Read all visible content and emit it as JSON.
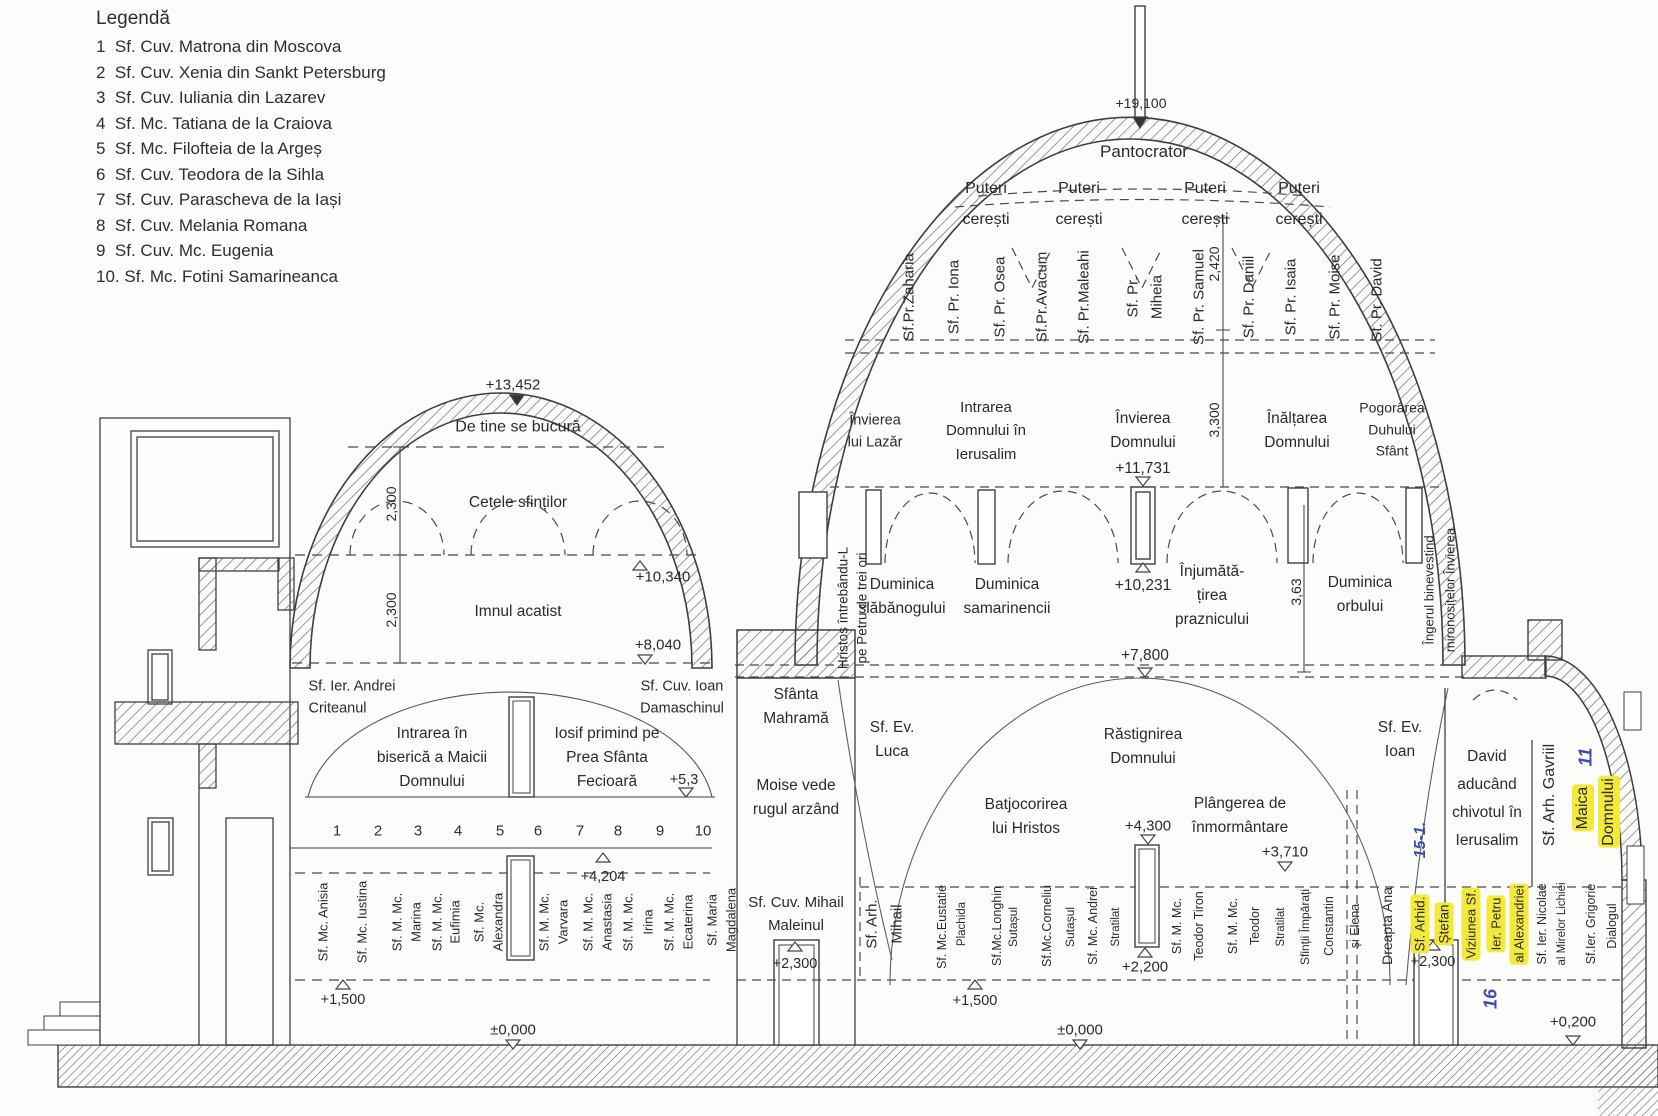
{
  "legend": {
    "title": "Legendă",
    "items": [
      {
        "no": "1",
        "name": "Sf. Cuv. Matrona din Moscova"
      },
      {
        "no": "2",
        "name": "Sf. Cuv. Xenia din Sankt Petersburg"
      },
      {
        "no": "3",
        "name": "Sf. Cuv. Iuliania din Lazarev"
      },
      {
        "no": "4",
        "name": "Sf. Mc. Tatiana de la Craiova"
      },
      {
        "no": "5",
        "name": "Sf. Mc. Filofteia de la Argeș"
      },
      {
        "no": "6",
        "name": "Sf. Cuv. Teodora de la Sihla"
      },
      {
        "no": "7",
        "name": "Sf. Cuv. Parascheva de la Iași"
      },
      {
        "no": "8",
        "name": "Sf. Cuv. Melania Romana"
      },
      {
        "no": "9",
        "name": "Sf. Cuv. Mc. Eugenia"
      },
      {
        "no": "10.",
        "name": "Sf. Mc. Fotini Samarineanca"
      }
    ]
  },
  "main_dome": {
    "apex_elev": "+19,100",
    "pantocrator": "Pantocrator",
    "puteri": "Puteri\ncerești",
    "prophets": [
      "Sf.Pr.Zaharia",
      "Sf. Pr. Iona",
      "Sf. Pr. Osea",
      "Sf.Pr.Avacum",
      "Sf. Pr.Maleahi",
      "Sf. Pr.",
      "Miheia",
      "Sf. Pr. Samuel",
      "Sf. Pr. Daniil",
      "Sf. Pr. Isaia",
      "Sf. Pr. Moise",
      "Sf. Pr. David"
    ],
    "dim_2420": "2,420",
    "dim_3300": "3,300",
    "invierea_lazar": "Învierea\nlui Lazăr",
    "intrarea_ierusalim": "Intrarea\nDomnului în\nIerusalim",
    "invierea_domnului": "Învierea\nDomnului",
    "inaltarea": "Înălțarea\nDomnului",
    "pogorarea": "Pogorârea\nDuhului\nSfânt",
    "elev_11731": "+11,731",
    "hristos_l1": "Hristos întrebându-L",
    "hristos_l2": "pe Petru de trei ori",
    "slabanogului": "Duminica\nslăbănogului",
    "samarinencii": "Duminica\nsamarinencii",
    "elev_10231": "+10,231",
    "injumatatirea": "Înjumătă-\nțirea\npraznicului",
    "dim_363": "3,63",
    "orbului": "Duminica\norbului",
    "ingerul_l1": "Îngerul binevestind",
    "ingerul_l2": "mironosițelor Învierea",
    "elev_7800": "+7,800"
  },
  "nave": {
    "sfanta_mahrama": "Sfânta\nMahramă",
    "sf_ev_luca": "Sf. Ev.\nLuca",
    "moise_rugul": "Moise vede\nrugul arzând",
    "rastignirea": "Răstignirea\nDomnului",
    "batjocorirea": "Batjocorirea\nlui Hristos",
    "elev_4300": "+4,300",
    "elev_2200": "+2,200",
    "plangerea": "Plângerea de\nînmormântare",
    "elev_3710": "+3,710",
    "sf_ev_ioan": "Sf. Ev.\nIoan",
    "arh_mihail_l1": "Sf. Arh.",
    "arh_mihail_l2": "Mihail",
    "saints": [
      "Sf. Mc.Eustatie",
      "Plachida",
      "Sf.Mc.Longhin",
      "Sutașul",
      "Sf.Mc.Corneliu",
      "Sutașul",
      "Sf. Mc. Andrei",
      "Stratilat",
      "Sf. M. Mc.",
      "Teodor Tiron",
      "Sf. M. Mc.",
      "Teodor",
      "Stratilat",
      "Sfinții Împărați",
      "Constantin",
      "și Elena"
    ],
    "dreapta_ana": "Dreapta Ana",
    "elev_1500": "+1,500",
    "elev_0000": "±0,000"
  },
  "left_dome": {
    "elev_13452": "+13,452",
    "de_tine": "De tine se bucură",
    "cetele": "Cetele sfinților",
    "dim_2300": "2,300",
    "elev_10340": "+10,340",
    "imnul": "Imnul acatist",
    "elev_8040": "+8,040",
    "andrei_criteanul": "Sf. Ier. Andrei\nCriteanul",
    "ioan_damaschinul": "Sf. Cuv. Ioan\nDamaschinul",
    "intrarea_biserica": "Intrarea în\nbiserică a Maicii\nDomnului",
    "iosif_primind": "Iosif primind pe\nPrea Sfânta\nFecioară",
    "elev_53": "+5,3",
    "numbers": [
      "1",
      "2",
      "3",
      "4",
      "5",
      "6",
      "7",
      "8",
      "9",
      "10"
    ],
    "elev_4204": "+4,204",
    "saints": [
      "Sf. Mc. Anisia",
      "Sf. Mc. Iustina",
      "Sf. M. Mc.",
      "Marina",
      "Sf. M. Mc.",
      "Eufimia",
      "Sf. Mc.",
      "Alexandra",
      "Sf. M. Mc.",
      "Varvara",
      "Sf. M. Mc.",
      "Anastasia",
      "Sf. M. Mc.",
      "Irina",
      "Sf. M. Mc.",
      "Ecaterina",
      "Sf. Maria",
      "Magdalena"
    ],
    "elev_1500": "+1,500",
    "elev_0000": "±0,000"
  },
  "narthex": {
    "mihail_maleinul": "Sf. Cuv. Mihail\nMaleinul",
    "elev_2300": "+2,300"
  },
  "chapel": {
    "david": "David\naducând\nchivotul în\nIerusalim",
    "gavriil": "Sf. Arh. Gavriil",
    "maica_l1": "Maica",
    "maica_l2": "Domnului",
    "stefan_l1": "Sf. Arhid.",
    "stefan_l2": "Ștefan",
    "elev_2300": "+2,300",
    "viziunea_l1": "Viziunea Sf.",
    "viziunea_l2": "Ier. Petru",
    "viziunea_l3": "al Alexandriei",
    "nicolae_l1": "Sf. Ier. Nicolae",
    "nicolae_l2": "al Mirelor Lichiei",
    "grigorie_l1": "Sf.Ier. Grigorie",
    "grigorie_l2": "Dialogul",
    "elev_0200": "+0,200",
    "annotations": {
      "a11": "11",
      "a15": "15-1.",
      "a16": "16"
    },
    "highlight_color": "#f3e93a",
    "annotation_color": "#3c4cb3"
  }
}
